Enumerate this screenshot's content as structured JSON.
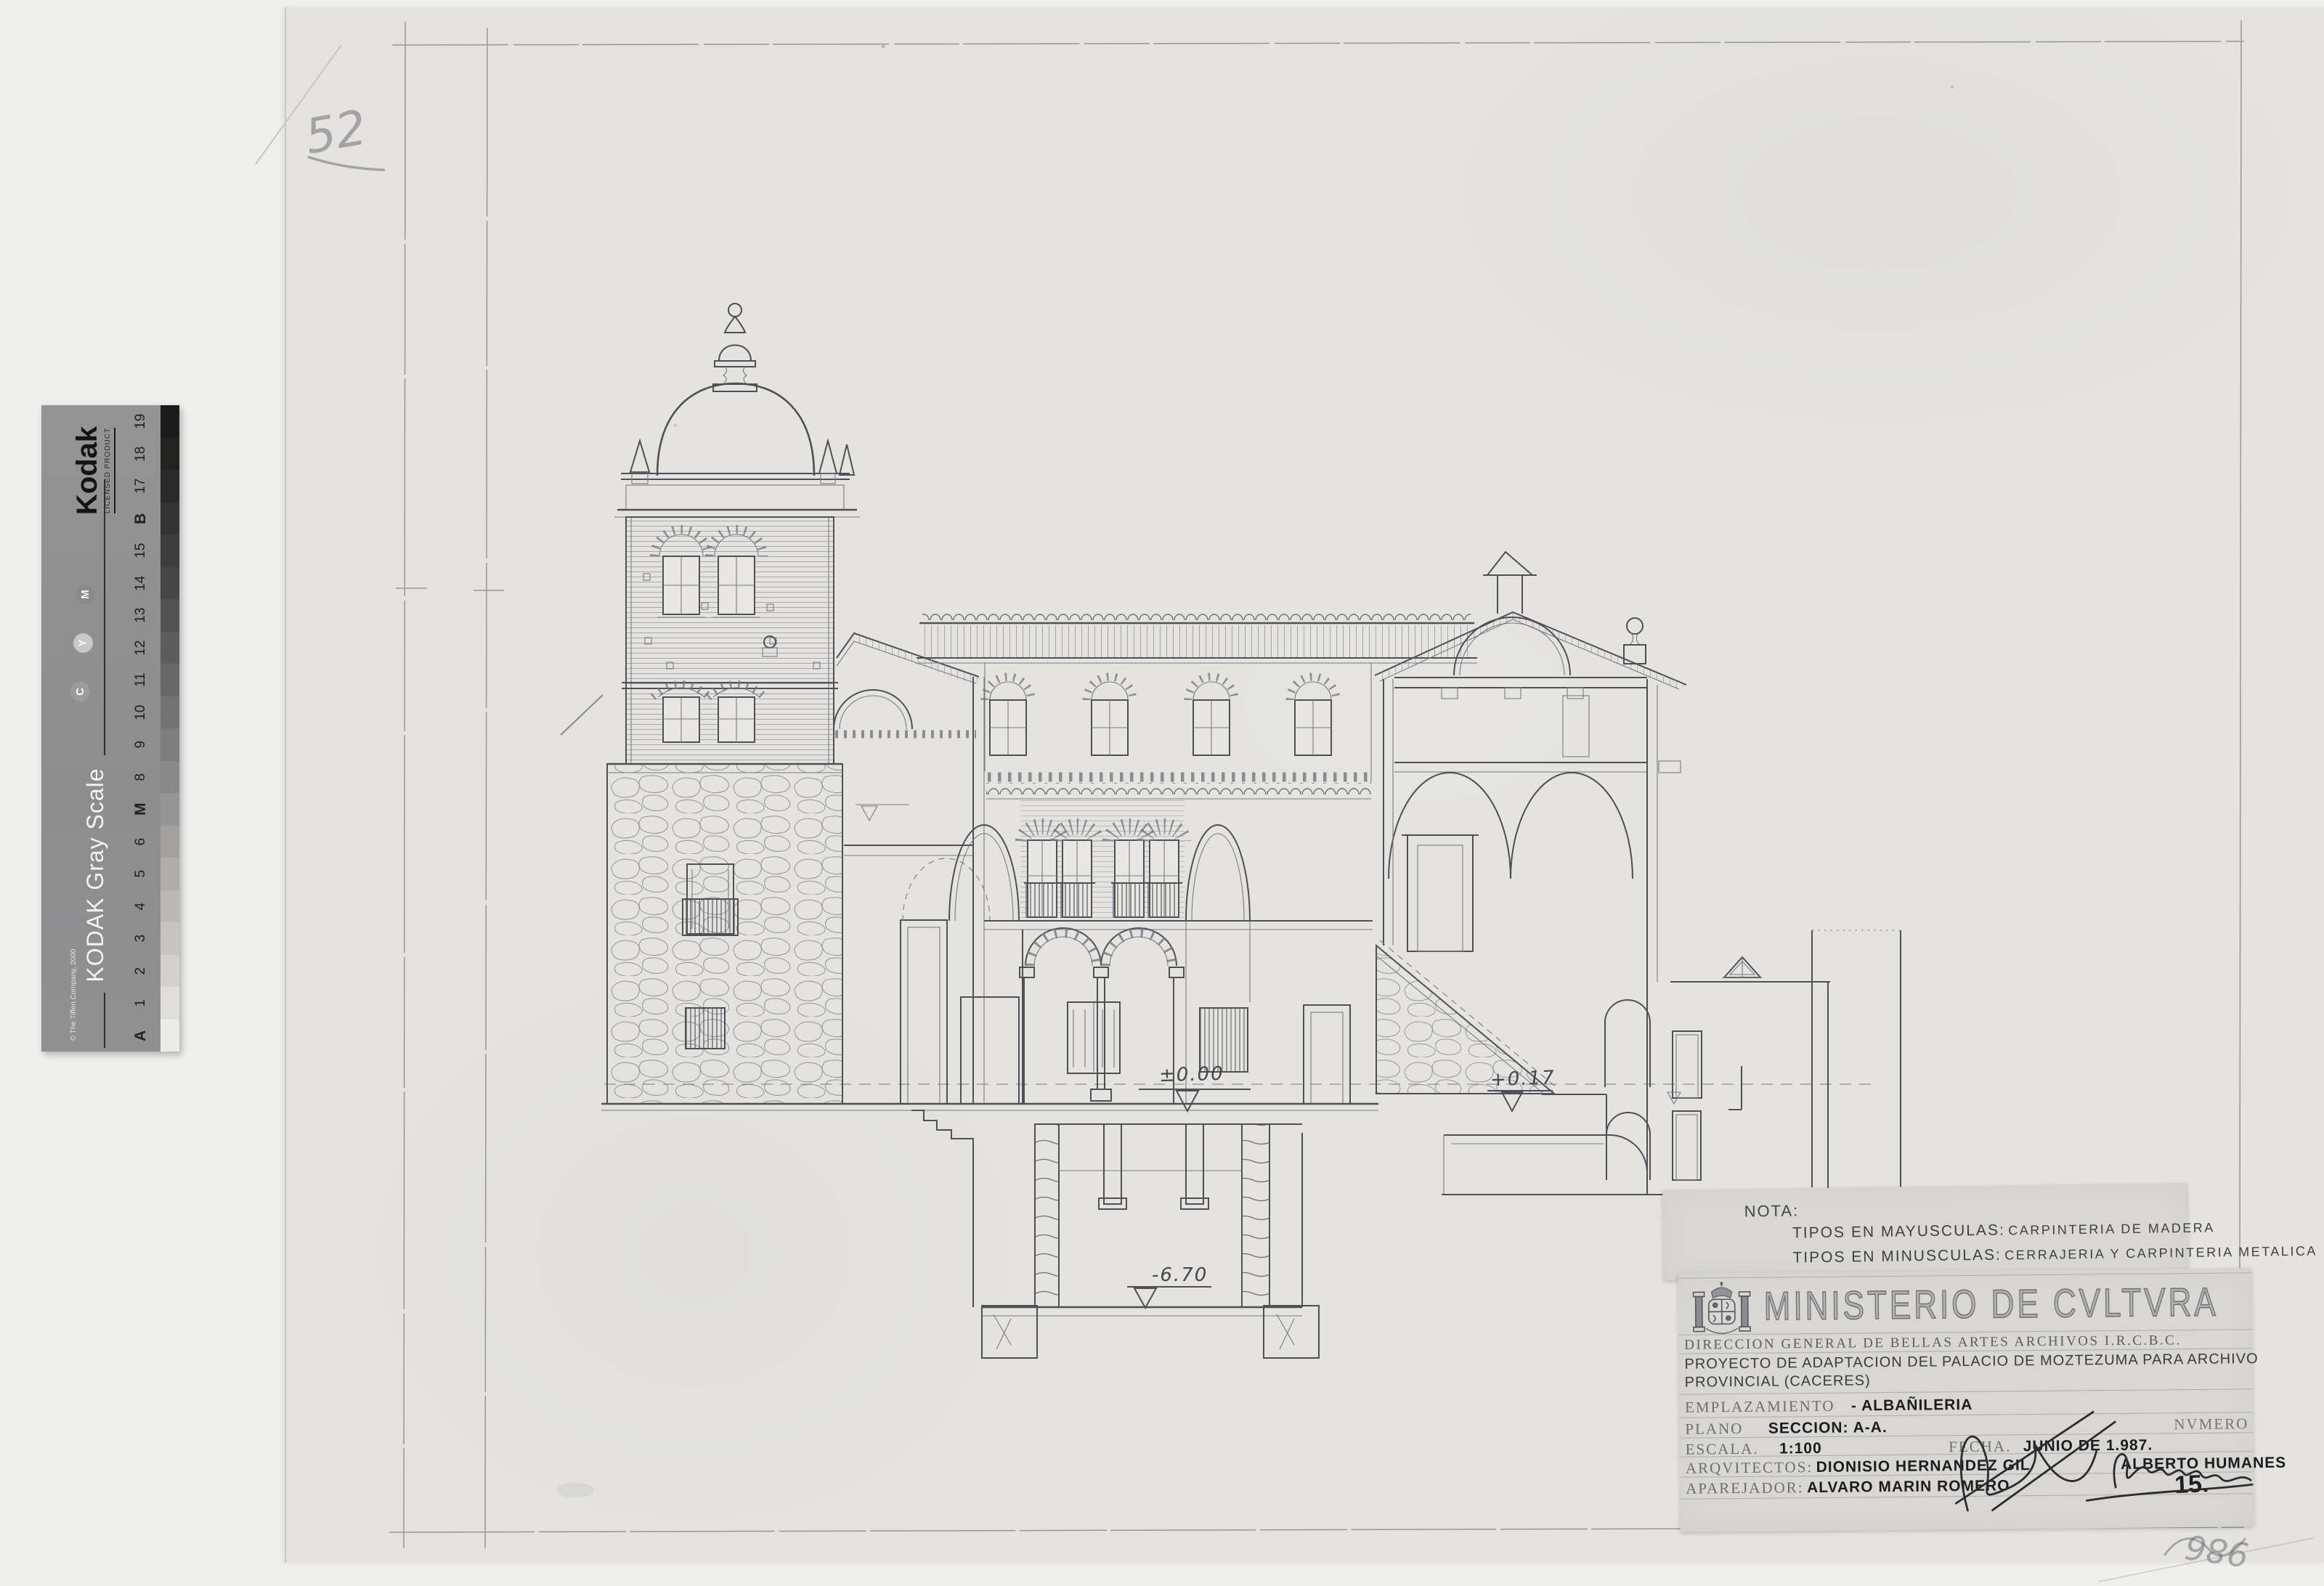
{
  "annotations": {
    "sheet_number_pencil": "52",
    "corner_scribble": "986"
  },
  "kodak_strip": {
    "brand": "Kodak",
    "licensed": "LICENSED PRODUCT",
    "title": "KODAK Gray Scale",
    "copyright": "© The Tiffen Company, 2000",
    "dots": [
      "M",
      "Y",
      "C"
    ],
    "patches": [
      {
        "label": "19",
        "color": "#1b1b1b"
      },
      {
        "label": "18",
        "color": "#232322"
      },
      {
        "label": "17",
        "color": "#2b2a2a"
      },
      {
        "label": "B",
        "color": "#343333",
        "bold": true
      },
      {
        "label": "15",
        "color": "#3e3d3d"
      },
      {
        "label": "14",
        "color": "#484747"
      },
      {
        "label": "13",
        "color": "#535252"
      },
      {
        "label": "12",
        "color": "#5e5d5d"
      },
      {
        "label": "11",
        "color": "#696868"
      },
      {
        "label": "10",
        "color": "#747373"
      },
      {
        "label": "9",
        "color": "#7f7e7e"
      },
      {
        "label": "8",
        "color": "#8a8989"
      },
      {
        "label": "M",
        "color": "#969595",
        "bold": true
      },
      {
        "label": "6",
        "color": "#a2a1a0"
      },
      {
        "label": "5",
        "color": "#aeadac"
      },
      {
        "label": "4",
        "color": "#bab9b8"
      },
      {
        "label": "3",
        "color": "#c6c5c4"
      },
      {
        "label": "2",
        "color": "#d2d1d0"
      },
      {
        "label": "1",
        "color": "#dfdedc"
      },
      {
        "label": "A",
        "color": "#ececea",
        "bold": true
      }
    ]
  },
  "drawing": {
    "levels": {
      "ground": "±0.00",
      "stair_landing": "+0.17",
      "cellar": "-6.70"
    }
  },
  "nota": {
    "heading": "NOTA:",
    "line1_label": "TIPOS EN MAYUSCULAS:",
    "line1_value": "CARPINTERIA DE MADERA",
    "line2_label": "TIPOS EN MINUSCULAS:",
    "line2_value": "CERRAJERIA Y CARPINTERIA METALICA"
  },
  "titleblock": {
    "ministry": "MINISTERIO DE CVLTVRA",
    "direction": "DIRECCION GENERAL DE BELLAS ARTES ARCHIVOS I.R.C.B.C.",
    "project_line1": "PROYECTO DE ADAPTACION DEL PALACIO DE MOZTEZUMA PARA ARCHIVO",
    "project_line2": "PROVINCIAL (CACERES)",
    "emplazamiento_label": "EMPLAZAMIENTO",
    "emplazamiento_value": "- ALBAÑILERIA",
    "plano_label": "PLANO",
    "plano_value": "SECCION: A-A.",
    "numero_label": "NVMERO",
    "escala_label": "ESCALA.",
    "escala_value": "1:100",
    "fecha_label": "FECHA.",
    "fecha_value": "JUNIO DE 1.987.",
    "arquitectos_label": "ARQVITECTOS:",
    "arquitectos_value": "DIONISIO HERNANDEZ GIL",
    "arquitectos_value2": "ALBERTO HUMANES",
    "aparejador_label": "APAREJADOR:",
    "aparejador_value": "ALVARO MARIN ROMERO",
    "plate_number": "15."
  },
  "colors": {
    "scanner_bg": "#eff0ee",
    "sheet": "#e4e3df",
    "overlay_paper": "#d8d7d3",
    "ink": "#4e4e55",
    "pencil": "#97979b",
    "kodak_bg": "#8f8f90"
  }
}
